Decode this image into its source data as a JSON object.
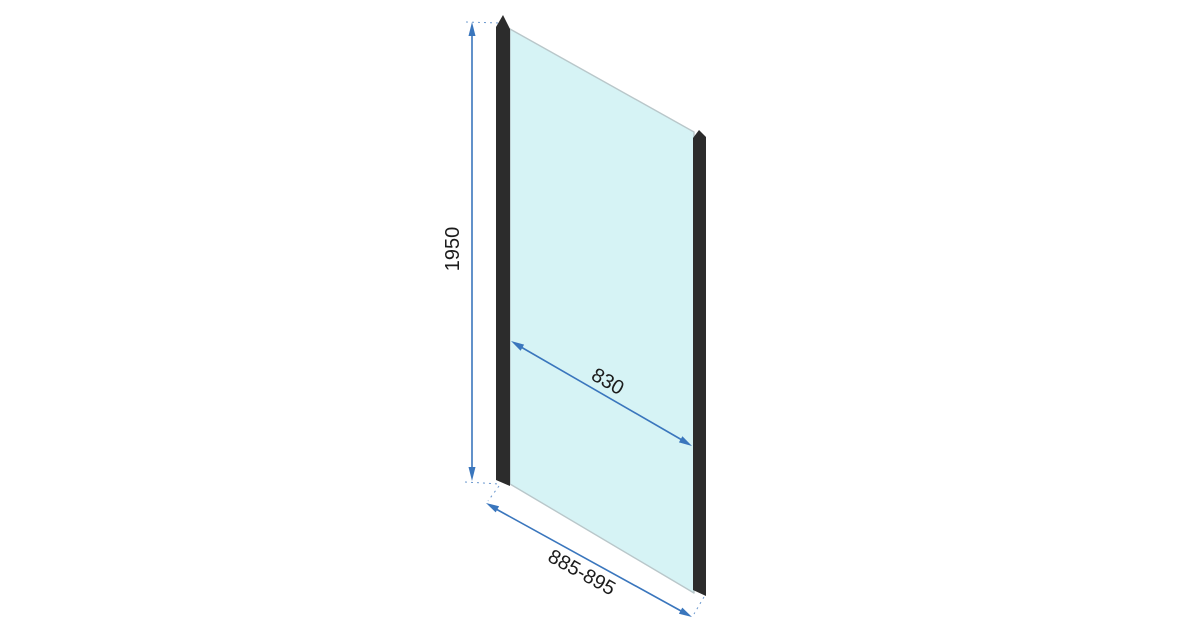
{
  "diagram": {
    "subject": "shower-glass-side-panel-technical-drawing",
    "dimensions": {
      "height_label": "1950",
      "glass_width_label": "830",
      "overall_width_label": "885-895"
    },
    "colors": {
      "background": "#ffffff",
      "glass": "#d6f3f5",
      "glass_edge": "#b9c7ca",
      "profile": "#2c2c2c",
      "profile_highlight": "#4a4a4a",
      "dimension_line": "#3a76bd",
      "text": "#1c1c1c"
    }
  }
}
